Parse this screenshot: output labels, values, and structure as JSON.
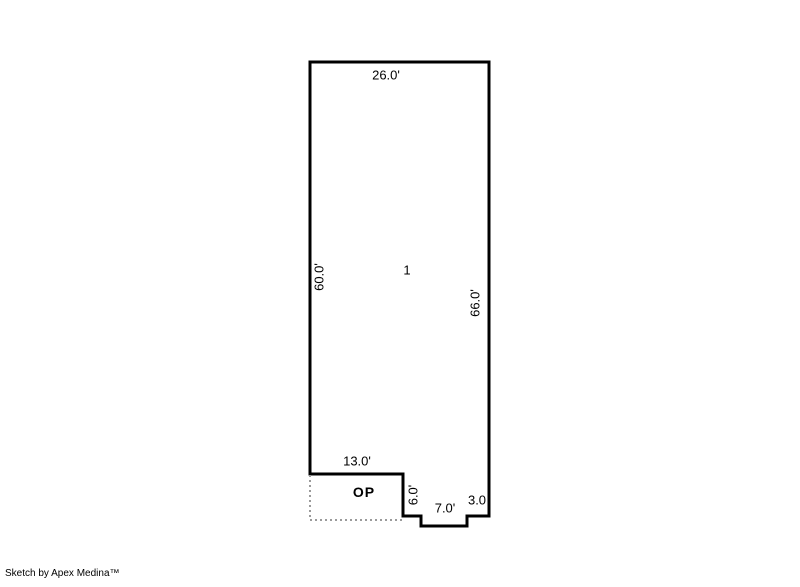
{
  "sketch": {
    "area_number": "1",
    "labels": {
      "top_width": "26.0'",
      "left_height": "60.0'",
      "right_height": "66.0'",
      "porch_width": "13.0'",
      "porch_abbrev": "OP",
      "porch_depth": "6.0'",
      "notch_width": "7.0'",
      "right_offset": "3.0"
    },
    "colors": {
      "outline": "#000000",
      "porch_dashed": "#9a9a9a",
      "background": "#ffffff"
    }
  },
  "footer": {
    "credit": "Sketch by Apex Medina™"
  }
}
